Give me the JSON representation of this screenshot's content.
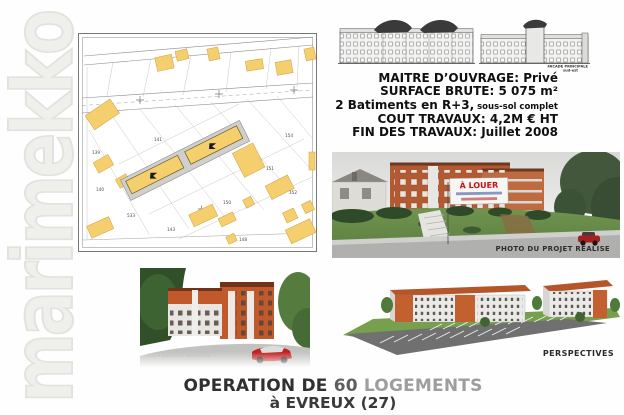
{
  "watermark": {
    "text": "marimekko"
  },
  "site_plan": {
    "parcels": [
      "141",
      "139",
      "140",
      "533",
      "154",
      "151",
      "152",
      "150",
      "148",
      "143"
    ]
  },
  "elevations": {
    "caption1": "FACADE PRINCIPALE",
    "caption2": "sud-est"
  },
  "info": {
    "line1": "MAITRE D’OUVRAGE: Privé",
    "line2": "SURFACE BRUTE: 5 075 m²",
    "line3_main": "2 Batiments en R+3,",
    "line3_small": " sous-sol complet",
    "line4": "COUT TRAVAUX: 4,2M € HT",
    "line5": "FIN DES TRAVAUX: Juillet 2008"
  },
  "photo": {
    "banner_text": "À LOUER",
    "caption": "PHOTO DU PROJET REALISE"
  },
  "render_left": {
    "credit": "C.E.2 Baumont Architecte"
  },
  "render_right": {
    "caption": "PERSPECTIVES"
  },
  "title": {
    "part1": "OPERATION DE ",
    "part2": "60 ",
    "part3": "LOGEMENTS",
    "line2": "à EVREUX (27)"
  },
  "colors": {
    "parcel_yellow": "#f5ce6e",
    "building_orange": "#c05a2c",
    "banner_red": "#c41212",
    "grass_green": "#6b9150"
  }
}
